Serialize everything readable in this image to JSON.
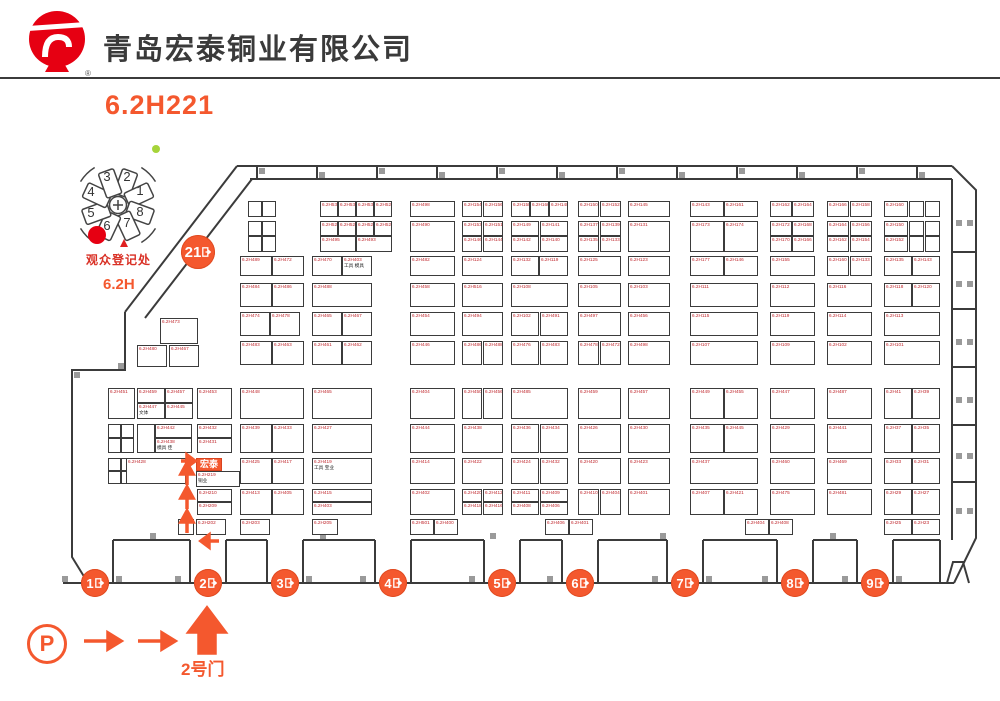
{
  "colors": {
    "accent": "#F4582E",
    "logo_red": "#E60012",
    "booth_label_red": "#C0272D",
    "wall": "#3B3B3B",
    "stub": "#9A9A9A",
    "registration_red": "#D93025",
    "green_dot": "#A6D43A"
  },
  "header": {
    "company": "青岛宏泰铜业有限公司",
    "booth_code": "6.2H221",
    "trademark": "®"
  },
  "minimap": {
    "registration_label": "观众登记处",
    "hall_label": "6.2H",
    "halls": [
      {
        "n": "1",
        "x": 80,
        "y": 52
      },
      {
        "n": "2",
        "x": 67,
        "y": 38
      },
      {
        "n": "3",
        "x": 47,
        "y": 38
      },
      {
        "n": "4",
        "x": 31,
        "y": 53
      },
      {
        "n": "5",
        "x": 31,
        "y": 74
      },
      {
        "n": "6",
        "x": 47,
        "y": 87
      },
      {
        "n": "7",
        "x": 67,
        "y": 84
      },
      {
        "n": "8",
        "x": 80,
        "y": 73
      }
    ]
  },
  "entrance": {
    "gate_label": "2号门",
    "parking_label": "P"
  },
  "gates": [
    {
      "label": "21",
      "x": 198,
      "y": 252,
      "r": 17
    },
    {
      "label": "1",
      "x": 95,
      "y": 583,
      "r": 14
    },
    {
      "label": "2",
      "x": 208,
      "y": 583,
      "r": 14
    },
    {
      "label": "3",
      "x": 285,
      "y": 583,
      "r": 14
    },
    {
      "label": "4",
      "x": 393,
      "y": 583,
      "r": 14
    },
    {
      "label": "5",
      "x": 502,
      "y": 583,
      "r": 14
    },
    {
      "label": "6",
      "x": 580,
      "y": 583,
      "r": 14
    },
    {
      "label": "7",
      "x": 685,
      "y": 583,
      "r": 14
    },
    {
      "label": "8",
      "x": 795,
      "y": 583,
      "r": 14
    },
    {
      "label": "9",
      "x": 875,
      "y": 583,
      "r": 14
    }
  ],
  "booths": [
    [
      248,
      201,
      14,
      16,
      ""
    ],
    [
      262,
      201,
      14,
      16,
      ""
    ],
    [
      320,
      201,
      18,
      16,
      "6.2H535"
    ],
    [
      338,
      201,
      18,
      16,
      "6.2H533"
    ],
    [
      356,
      201,
      18,
      16,
      "6.2H531"
    ],
    [
      374,
      201,
      18,
      16,
      "6.2H529"
    ],
    [
      410,
      201,
      45,
      16,
      "6.2H498"
    ],
    [
      462,
      201,
      20,
      16,
      "6.2H154"
    ],
    [
      483,
      201,
      20,
      16,
      "6.2H156"
    ],
    [
      511,
      201,
      19,
      16,
      "6.2H158"
    ],
    [
      530,
      201,
      19,
      16,
      "6.2H160"
    ],
    [
      549,
      201,
      19,
      16,
      "6.2H148"
    ],
    [
      578,
      201,
      21,
      16,
      "6.2H150"
    ],
    [
      600,
      201,
      21,
      16,
      "6.2H152"
    ],
    [
      628,
      201,
      42,
      16,
      "6.2H145"
    ],
    [
      690,
      201,
      34,
      16,
      "6.2H143"
    ],
    [
      724,
      201,
      34,
      16,
      "6.2H161"
    ],
    [
      770,
      201,
      22,
      16,
      "6.2H162"
    ],
    [
      792,
      201,
      22,
      16,
      "6.2H164"
    ],
    [
      827,
      201,
      22,
      16,
      "6.2H166"
    ],
    [
      850,
      201,
      22,
      16,
      "6.2H158"
    ],
    [
      884,
      201,
      24,
      16,
      "6.2H160"
    ],
    [
      909,
      201,
      15,
      16,
      ""
    ],
    [
      925,
      201,
      15,
      16,
      ""
    ],
    [
      248,
      221,
      14,
      15,
      ""
    ],
    [
      262,
      221,
      14,
      15,
      ""
    ],
    [
      248,
      236,
      14,
      16,
      ""
    ],
    [
      262,
      236,
      14,
      16,
      ""
    ],
    [
      320,
      221,
      18,
      15,
      "6.2H527"
    ],
    [
      338,
      221,
      18,
      15,
      "6.2H525"
    ],
    [
      356,
      221,
      18,
      15,
      "6.2H523"
    ],
    [
      374,
      221,
      18,
      15,
      "6.2H521"
    ],
    [
      320,
      236,
      36,
      16,
      "6.2H495"
    ],
    [
      356,
      236,
      36,
      16,
      "6.2H493"
    ],
    [
      410,
      221,
      45,
      31,
      "6.2H490"
    ],
    [
      462,
      221,
      20,
      15,
      "6.2H153"
    ],
    [
      483,
      221,
      20,
      15,
      "6.2H151"
    ],
    [
      462,
      236,
      20,
      16,
      "6.2H146"
    ],
    [
      483,
      236,
      20,
      16,
      "6.2H144"
    ],
    [
      511,
      221,
      28,
      15,
      "6.2H149"
    ],
    [
      540,
      221,
      28,
      15,
      "6.2H141"
    ],
    [
      511,
      236,
      28,
      16,
      "6.2H142"
    ],
    [
      540,
      236,
      28,
      16,
      "6.2H140"
    ],
    [
      578,
      221,
      21,
      15,
      "6.2H137"
    ],
    [
      600,
      221,
      21,
      15,
      "6.2H139"
    ],
    [
      578,
      236,
      21,
      16,
      "6.2H135"
    ],
    [
      600,
      236,
      21,
      16,
      "6.2H133"
    ],
    [
      628,
      221,
      42,
      31,
      "6.2H131"
    ],
    [
      690,
      221,
      34,
      31,
      "6.2H173"
    ],
    [
      724,
      221,
      34,
      31,
      "6.2H174"
    ],
    [
      770,
      221,
      22,
      15,
      "6.2H172"
    ],
    [
      792,
      221,
      22,
      15,
      "6.2H168"
    ],
    [
      770,
      236,
      22,
      16,
      "6.2H170"
    ],
    [
      792,
      236,
      22,
      16,
      "6.2H166"
    ],
    [
      827,
      221,
      22,
      15,
      "6.2H164"
    ],
    [
      850,
      221,
      22,
      15,
      "6.2H156"
    ],
    [
      827,
      236,
      22,
      16,
      "6.2H162"
    ],
    [
      850,
      236,
      22,
      16,
      "6.2H154"
    ],
    [
      884,
      221,
      24,
      15,
      "6.2H150"
    ],
    [
      884,
      236,
      24,
      16,
      "6.2H152"
    ],
    [
      909,
      221,
      15,
      15,
      ""
    ],
    [
      925,
      221,
      15,
      15,
      ""
    ],
    [
      909,
      236,
      15,
      16,
      ""
    ],
    [
      925,
      236,
      15,
      16,
      ""
    ],
    [
      240,
      256,
      32,
      20,
      "6.2H489"
    ],
    [
      272,
      256,
      32,
      20,
      "6.2H472"
    ],
    [
      312,
      256,
      30,
      20,
      "6.2H470"
    ],
    [
      342,
      256,
      30,
      20,
      "6.2H403",
      "工具 模具"
    ],
    [
      410,
      256,
      45,
      20,
      "6.2H482"
    ],
    [
      462,
      256,
      41,
      20,
      "6.2H124"
    ],
    [
      511,
      256,
      28,
      20,
      "6.2H132"
    ],
    [
      539,
      256,
      29,
      20,
      "6.2H119"
    ],
    [
      578,
      256,
      43,
      20,
      "6.2H125"
    ],
    [
      628,
      256,
      42,
      20,
      "6.2H123"
    ],
    [
      690,
      256,
      34,
      20,
      "6.2H177"
    ],
    [
      724,
      256,
      34,
      20,
      "6.2H146"
    ],
    [
      770,
      256,
      45,
      20,
      "6.2H155"
    ],
    [
      827,
      256,
      22,
      20,
      "6.2H160"
    ],
    [
      850,
      256,
      22,
      20,
      "6.2H133"
    ],
    [
      884,
      256,
      28,
      20,
      "6.2H135"
    ],
    [
      912,
      256,
      28,
      20,
      "6.2H143"
    ],
    [
      240,
      283,
      32,
      24,
      "6.2H484"
    ],
    [
      272,
      283,
      32,
      24,
      "6.2H486"
    ],
    [
      312,
      283,
      60,
      24,
      "6.2H488"
    ],
    [
      410,
      283,
      45,
      24,
      "6.2H458"
    ],
    [
      462,
      283,
      41,
      24,
      "6.2H516"
    ],
    [
      511,
      283,
      57,
      24,
      "6.2H108"
    ],
    [
      578,
      283,
      43,
      24,
      "6.2H105"
    ],
    [
      628,
      283,
      42,
      24,
      "6.2H103"
    ],
    [
      690,
      283,
      68,
      24,
      "6.2H111"
    ],
    [
      770,
      283,
      45,
      24,
      "6.2H112"
    ],
    [
      827,
      283,
      45,
      24,
      "6.2H116"
    ],
    [
      884,
      283,
      28,
      24,
      "6.2H118"
    ],
    [
      912,
      283,
      28,
      24,
      "6.2H120"
    ],
    [
      160,
      318,
      38,
      26,
      "6.2H473"
    ],
    [
      240,
      312,
      30,
      24,
      "6.2H474"
    ],
    [
      270,
      312,
      30,
      24,
      "6.2H478"
    ],
    [
      312,
      312,
      30,
      24,
      "6.2H465"
    ],
    [
      342,
      312,
      30,
      24,
      "6.2H467"
    ],
    [
      410,
      312,
      45,
      24,
      "6.2H454"
    ],
    [
      462,
      312,
      41,
      24,
      "6.2H494"
    ],
    [
      511,
      312,
      28,
      24,
      "6.2H102"
    ],
    [
      540,
      312,
      28,
      24,
      "6.2H491"
    ],
    [
      578,
      312,
      43,
      24,
      "6.2H497"
    ],
    [
      628,
      312,
      42,
      24,
      "6.2H456"
    ],
    [
      690,
      312,
      68,
      24,
      "6.2H115"
    ],
    [
      770,
      312,
      45,
      24,
      "6.2H119"
    ],
    [
      827,
      312,
      45,
      24,
      "6.2H114"
    ],
    [
      884,
      312,
      56,
      24,
      "6.2H113"
    ],
    [
      137,
      345,
      30,
      22,
      "6.2H480"
    ],
    [
      169,
      345,
      30,
      22,
      "6.2H467"
    ],
    [
      240,
      341,
      32,
      24,
      "6.2H483"
    ],
    [
      272,
      341,
      32,
      24,
      "6.2H463"
    ],
    [
      312,
      341,
      30,
      24,
      "6.2H461"
    ],
    [
      342,
      341,
      30,
      24,
      "6.2H462"
    ],
    [
      410,
      341,
      45,
      24,
      "6.2H446"
    ],
    [
      462,
      341,
      20,
      24,
      "6.2H486"
    ],
    [
      483,
      341,
      20,
      24,
      "6.2H488"
    ],
    [
      511,
      341,
      28,
      24,
      "6.2H476"
    ],
    [
      540,
      341,
      28,
      24,
      "6.2H483"
    ],
    [
      578,
      341,
      21,
      24,
      "6.2H478"
    ],
    [
      600,
      341,
      21,
      24,
      "6.2H472"
    ],
    [
      628,
      341,
      42,
      24,
      "6.2H498"
    ],
    [
      690,
      341,
      68,
      24,
      "6.2H107"
    ],
    [
      770,
      341,
      45,
      24,
      "6.2H109"
    ],
    [
      827,
      341,
      45,
      24,
      "6.2H102"
    ],
    [
      884,
      341,
      56,
      24,
      "6.2H101"
    ],
    [
      108,
      388,
      27,
      31,
      "6.2H451"
    ],
    [
      137,
      388,
      28,
      15,
      "6.2H459"
    ],
    [
      165,
      388,
      28,
      15,
      "6.2H457"
    ],
    [
      137,
      403,
      28,
      16,
      "6.2H447",
      "文体"
    ],
    [
      165,
      403,
      28,
      16,
      "6.2H445"
    ],
    [
      197,
      388,
      35,
      31,
      "6.2H453"
    ],
    [
      240,
      388,
      64,
      31,
      "6.2H448"
    ],
    [
      312,
      388,
      60,
      31,
      "6.2H465"
    ],
    [
      410,
      388,
      45,
      31,
      "6.2H404"
    ],
    [
      462,
      388,
      20,
      31,
      "6.2H450"
    ],
    [
      483,
      388,
      20,
      31,
      "6.2H456"
    ],
    [
      511,
      388,
      57,
      31,
      "6.2H485"
    ],
    [
      578,
      388,
      43,
      31,
      "6.2H459"
    ],
    [
      628,
      388,
      42,
      31,
      "6.2H457"
    ],
    [
      690,
      388,
      34,
      31,
      "6.2H449"
    ],
    [
      724,
      388,
      34,
      31,
      "6.2H455"
    ],
    [
      770,
      388,
      45,
      31,
      "6.2H447"
    ],
    [
      827,
      388,
      45,
      31,
      "6.2H487"
    ],
    [
      884,
      388,
      28,
      31,
      "6.2H41"
    ],
    [
      912,
      388,
      28,
      31,
      "6.2H39"
    ],
    [
      108,
      424,
      13,
      14,
      ""
    ],
    [
      121,
      424,
      13,
      14,
      ""
    ],
    [
      108,
      438,
      13,
      15,
      ""
    ],
    [
      121,
      438,
      13,
      15,
      ""
    ],
    [
      137,
      424,
      18,
      29,
      ""
    ],
    [
      155,
      424,
      37,
      14,
      "6.2H442"
    ],
    [
      155,
      438,
      37,
      15,
      "6.2H438",
      "模具 佳"
    ],
    [
      197,
      424,
      35,
      14,
      "6.2H432"
    ],
    [
      197,
      438,
      35,
      15,
      "6.2H431"
    ],
    [
      240,
      424,
      32,
      29,
      "6.2H439"
    ],
    [
      272,
      424,
      32,
      29,
      "6.2H433"
    ],
    [
      312,
      424,
      60,
      29,
      "6.2H427"
    ],
    [
      410,
      424,
      45,
      29,
      "6.2H444"
    ],
    [
      462,
      424,
      41,
      29,
      "6.2H438"
    ],
    [
      511,
      424,
      28,
      29,
      "6.2H436"
    ],
    [
      540,
      424,
      28,
      29,
      "6.2H434"
    ],
    [
      578,
      424,
      43,
      29,
      "6.2H426"
    ],
    [
      628,
      424,
      42,
      29,
      "6.2H430"
    ],
    [
      690,
      424,
      34,
      29,
      "6.2H435"
    ],
    [
      724,
      424,
      34,
      29,
      "6.2H445"
    ],
    [
      770,
      424,
      45,
      29,
      "6.2H429"
    ],
    [
      827,
      424,
      45,
      29,
      "6.2H441"
    ],
    [
      884,
      424,
      28,
      29,
      "6.2H37"
    ],
    [
      912,
      424,
      28,
      29,
      "6.2H35"
    ],
    [
      108,
      458,
      13,
      13,
      ""
    ],
    [
      121,
      458,
      13,
      13,
      ""
    ],
    [
      108,
      471,
      13,
      13,
      ""
    ],
    [
      121,
      471,
      13,
      13,
      ""
    ],
    [
      126,
      458,
      60,
      26,
      "6.2H428"
    ],
    [
      196,
      458,
      26,
      13,
      "宏泰",
      "",
      1
    ],
    [
      196,
      471,
      44,
      16,
      "6.2H219",
      "铜业"
    ],
    [
      240,
      458,
      32,
      26,
      "6.2H425"
    ],
    [
      272,
      458,
      32,
      26,
      "6.2H417"
    ],
    [
      312,
      458,
      60,
      26,
      "6.2H419",
      "工具 宝业"
    ],
    [
      410,
      458,
      45,
      26,
      "6.2H414"
    ],
    [
      462,
      458,
      41,
      26,
      "6.2H422"
    ],
    [
      511,
      458,
      28,
      26,
      "6.2H424"
    ],
    [
      540,
      458,
      28,
      26,
      "6.2H432"
    ],
    [
      578,
      458,
      43,
      26,
      "6.2H420"
    ],
    [
      628,
      458,
      42,
      26,
      "6.2H423"
    ],
    [
      690,
      458,
      68,
      26,
      "6.2H437"
    ],
    [
      770,
      458,
      45,
      26,
      "6.2H460"
    ],
    [
      827,
      458,
      45,
      26,
      "6.2H469"
    ],
    [
      884,
      458,
      28,
      26,
      "6.2H33"
    ],
    [
      912,
      458,
      28,
      26,
      "6.2H31"
    ],
    [
      197,
      489,
      35,
      13,
      "6.2H210"
    ],
    [
      197,
      502,
      35,
      13,
      "6.2H209"
    ],
    [
      240,
      489,
      32,
      26,
      "6.2H413"
    ],
    [
      272,
      489,
      32,
      26,
      "6.2H405"
    ],
    [
      312,
      489,
      60,
      13,
      "6.2H415"
    ],
    [
      312,
      502,
      60,
      13,
      "6.2H403"
    ],
    [
      410,
      489,
      45,
      26,
      "6.2H402"
    ],
    [
      462,
      489,
      20,
      13,
      "6.2H420"
    ],
    [
      483,
      489,
      20,
      13,
      "6.2H412"
    ],
    [
      462,
      502,
      20,
      13,
      "6.2H418"
    ],
    [
      483,
      502,
      20,
      13,
      "6.2H416"
    ],
    [
      511,
      489,
      28,
      13,
      "6.2H411"
    ],
    [
      540,
      489,
      28,
      13,
      "6.2H409"
    ],
    [
      511,
      502,
      28,
      13,
      "6.2H408"
    ],
    [
      540,
      502,
      28,
      13,
      "6.2H406"
    ],
    [
      578,
      489,
      21,
      26,
      "6.2H410"
    ],
    [
      600,
      489,
      21,
      26,
      "6.2H404"
    ],
    [
      628,
      489,
      42,
      26,
      "6.2H401"
    ],
    [
      690,
      489,
      34,
      26,
      "6.2H407"
    ],
    [
      724,
      489,
      34,
      26,
      "6.2H421"
    ],
    [
      770,
      489,
      45,
      26,
      "6.2H475"
    ],
    [
      827,
      489,
      45,
      26,
      "6.2H481"
    ],
    [
      884,
      489,
      28,
      26,
      "6.2H29"
    ],
    [
      912,
      489,
      28,
      26,
      "6.2H27"
    ],
    [
      178,
      519,
      16,
      16,
      ""
    ],
    [
      196,
      519,
      30,
      16,
      "6.2H202"
    ],
    [
      240,
      519,
      30,
      16,
      "6.2H203"
    ],
    [
      312,
      519,
      26,
      16,
      "6.2H205"
    ],
    [
      410,
      519,
      24,
      16,
      "6.2H501"
    ],
    [
      434,
      519,
      24,
      16,
      "6.2H400"
    ],
    [
      545,
      519,
      24,
      16,
      "6.2H406"
    ],
    [
      569,
      519,
      24,
      16,
      "6.2H401"
    ],
    [
      745,
      519,
      24,
      16,
      "6.2H404"
    ],
    [
      769,
      519,
      24,
      16,
      "6.2H408"
    ],
    [
      884,
      519,
      28,
      16,
      "6.2H25"
    ],
    [
      912,
      519,
      28,
      16,
      "6.2H23"
    ]
  ]
}
